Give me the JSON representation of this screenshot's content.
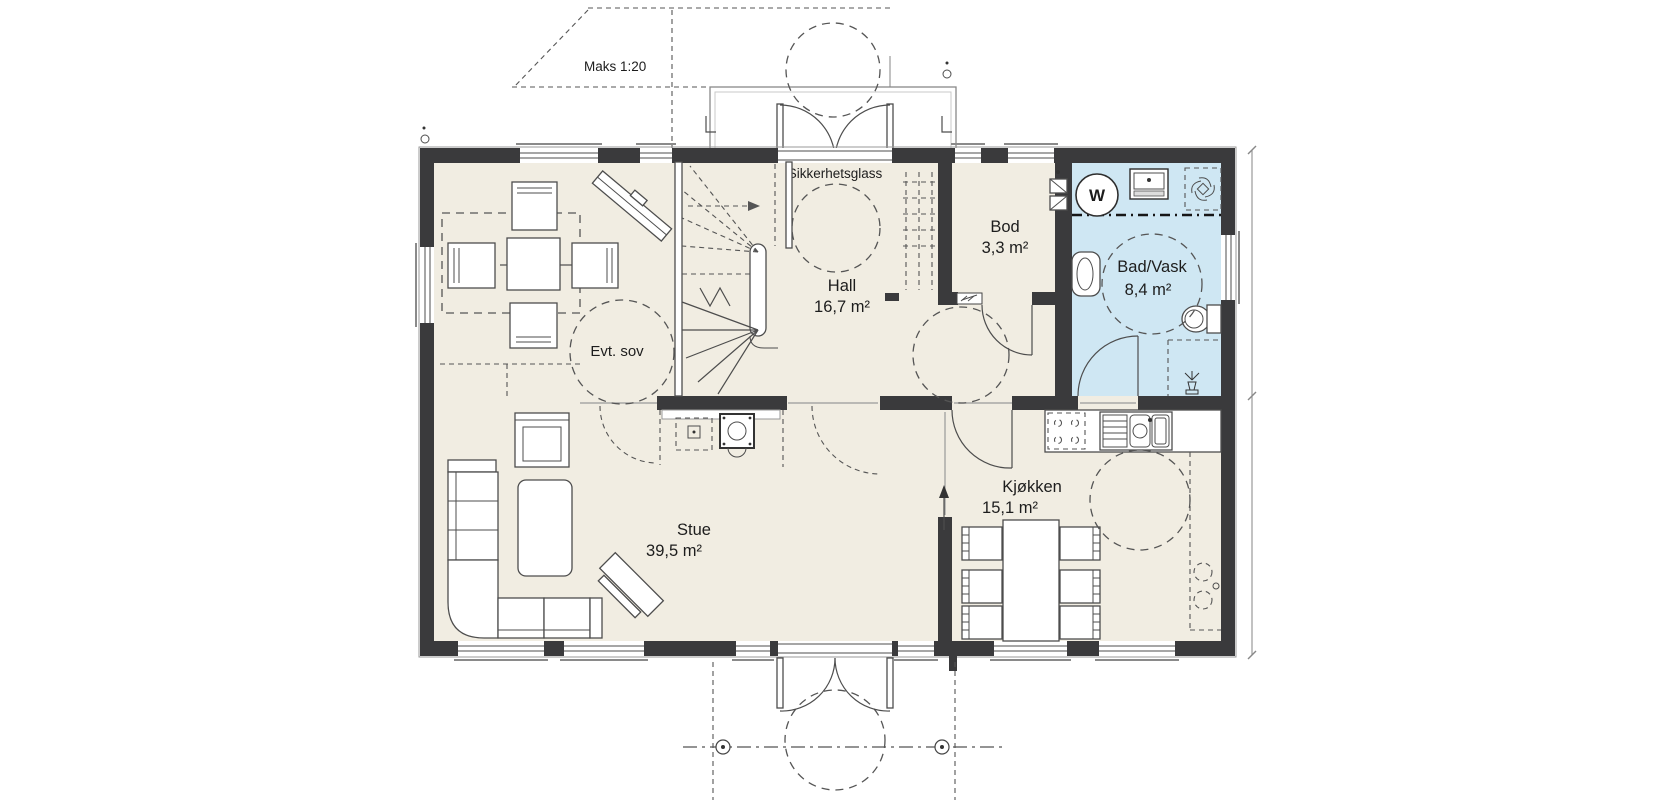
{
  "plan": {
    "scale_note": "Maks 1:20",
    "door_note": "Sikkerhetsglass",
    "rooms": {
      "evt_sov": {
        "name": "Evt. sov"
      },
      "hall": {
        "name": "Hall",
        "area": "16,7 m²"
      },
      "bod": {
        "name": "Bod",
        "area": "3,3 m²"
      },
      "bad_vask": {
        "name": "Bad/Vask",
        "area": "8,4 m²"
      },
      "stue": {
        "name": "Stue",
        "area": "39,5 m²"
      },
      "kjokken": {
        "name": "Kjøkken",
        "area": "15,1 m²"
      }
    },
    "fixtures": {
      "washing_machine_label": "W"
    },
    "colors": {
      "wall": "#3a3a3c",
      "floor": "#f1ede2",
      "bathroom_floor": "#cfe7f3",
      "line": "#4d4d4d",
      "background": "#ffffff"
    }
  }
}
